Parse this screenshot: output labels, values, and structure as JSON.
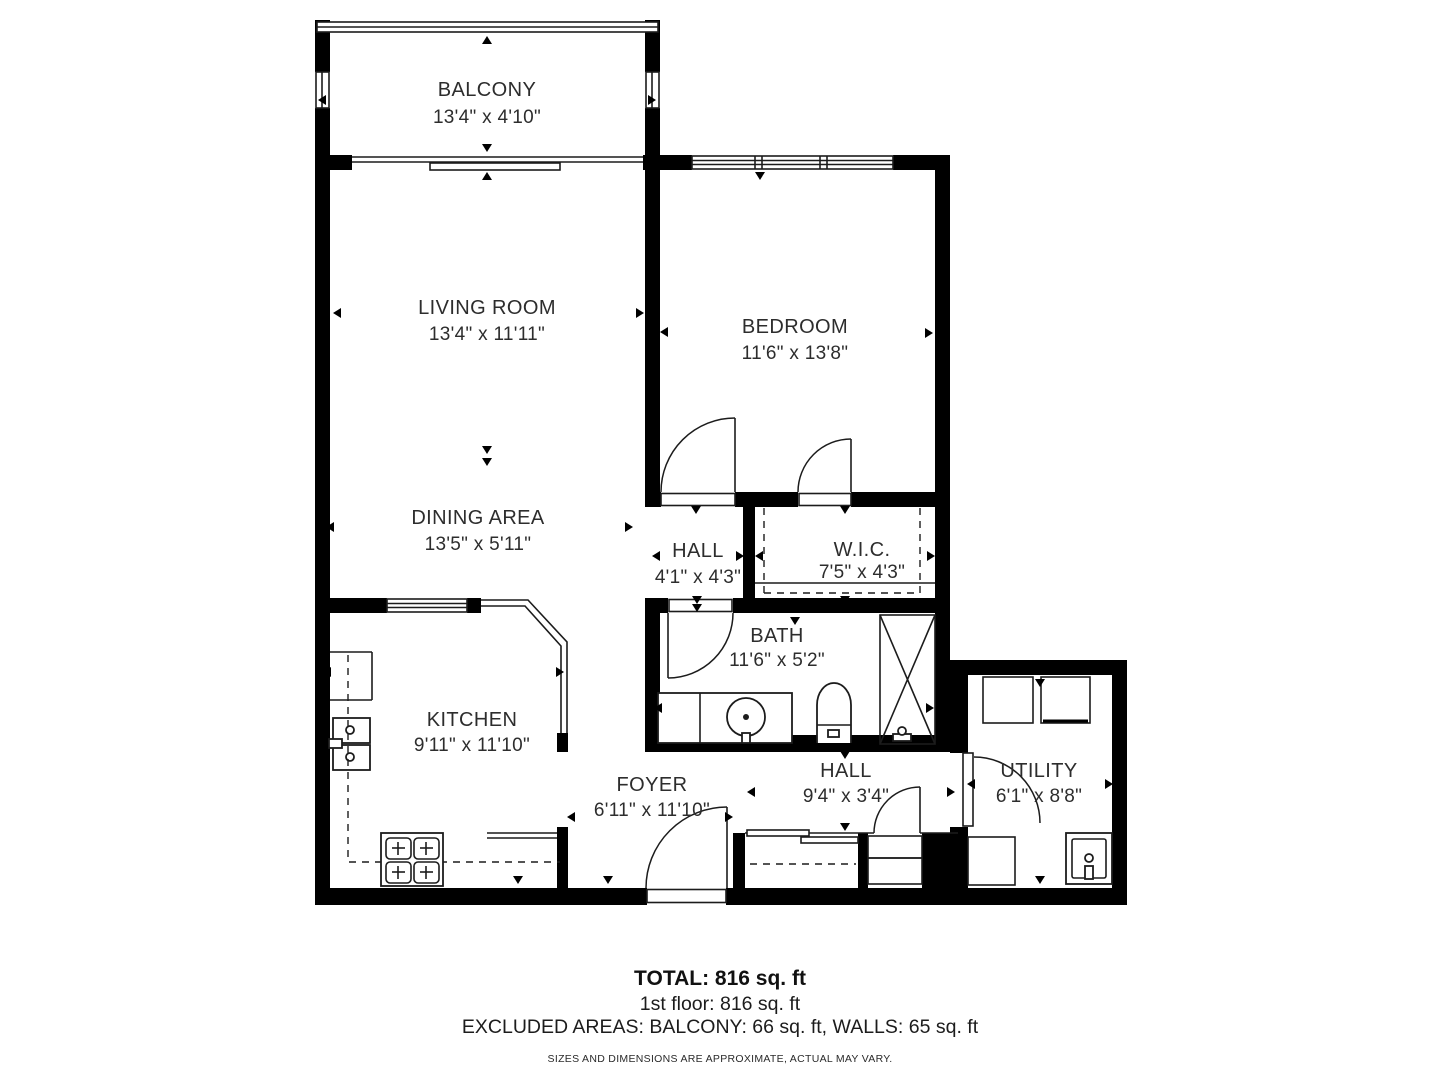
{
  "plan": {
    "rooms": [
      {
        "name": "BALCONY",
        "dims": "13'4\" x 4'10\""
      },
      {
        "name": "LIVING ROOM",
        "dims": "13'4\" x 11'11\""
      },
      {
        "name": "BEDROOM",
        "dims": "11'6\" x 13'8\""
      },
      {
        "name": "DINING AREA",
        "dims": "13'5\" x 5'11\""
      },
      {
        "name": "HALL",
        "dims": "4'1\" x 4'3\""
      },
      {
        "name": "W.I.C.",
        "dims": "7'5\" x 4'3\""
      },
      {
        "name": "BATH",
        "dims": "11'6\" x 5'2\""
      },
      {
        "name": "KITCHEN",
        "dims": "9'11\" x 11'10\""
      },
      {
        "name": "FOYER",
        "dims": "6'11\" x 11'10\""
      },
      {
        "name": "HALL",
        "dims": "9'4\" x 3'4\""
      },
      {
        "name": "UTILITY",
        "dims": "6'1\" x 8'8\""
      }
    ],
    "summary": {
      "total": "TOTAL: 816 sq. ft",
      "floor": "1st floor: 816 sq. ft",
      "excluded": "EXCLUDED AREAS: BALCONY: 66 sq. ft, WALLS: 65 sq. ft",
      "disclaimer": "SIZES AND DIMENSIONS ARE APPROXIMATE, ACTUAL MAY VARY."
    },
    "colors": {
      "wall": "#000000",
      "line": "#1c1c1c",
      "background": "#ffffff"
    }
  }
}
